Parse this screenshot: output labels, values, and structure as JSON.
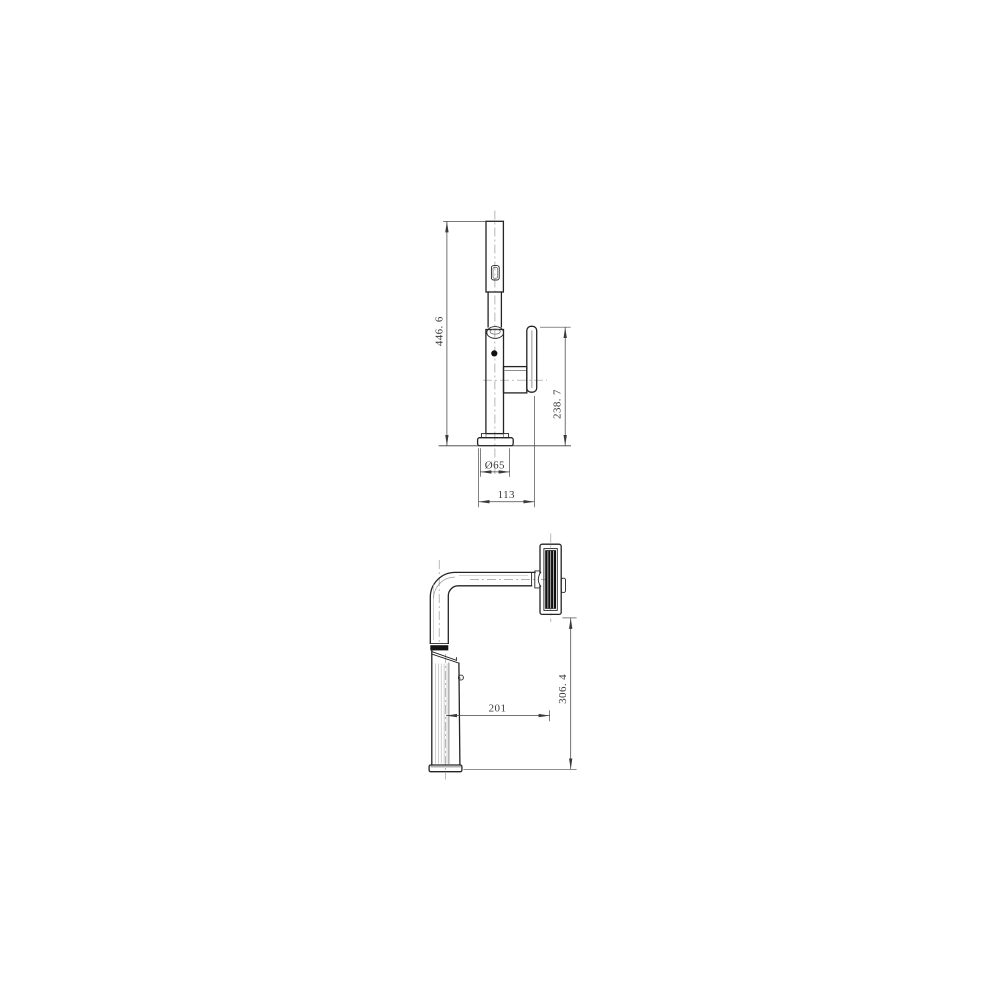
{
  "page": {
    "background": "#ffffff"
  },
  "drawing": {
    "kind": "technical dimension drawing",
    "subject": "pull-out faucet, two orthographic views",
    "units": "mm",
    "colors": {
      "line": "#242424",
      "dimension": "#454545",
      "centerline": "#999999",
      "spray_face_fill": "#101010"
    },
    "front_view": {
      "dimensions": [
        {
          "id": "overall-height",
          "label": "446. 6",
          "value": 446.6,
          "orientation": "vertical"
        },
        {
          "id": "handle-top-height",
          "label": "238. 7",
          "value": 238.7,
          "orientation": "vertical"
        },
        {
          "id": "base-diameter",
          "label": "Ø65",
          "value": 65,
          "orientation": "horizontal"
        },
        {
          "id": "overall-width",
          "label": "113",
          "value": 113,
          "orientation": "horizontal"
        }
      ]
    },
    "side_view": {
      "dimensions": [
        {
          "id": "spout-reach",
          "label": "201",
          "value": 201,
          "orientation": "horizontal"
        },
        {
          "id": "spout-deck-height",
          "label": "306. 4",
          "value": 306.4,
          "orientation": "vertical"
        }
      ]
    }
  }
}
